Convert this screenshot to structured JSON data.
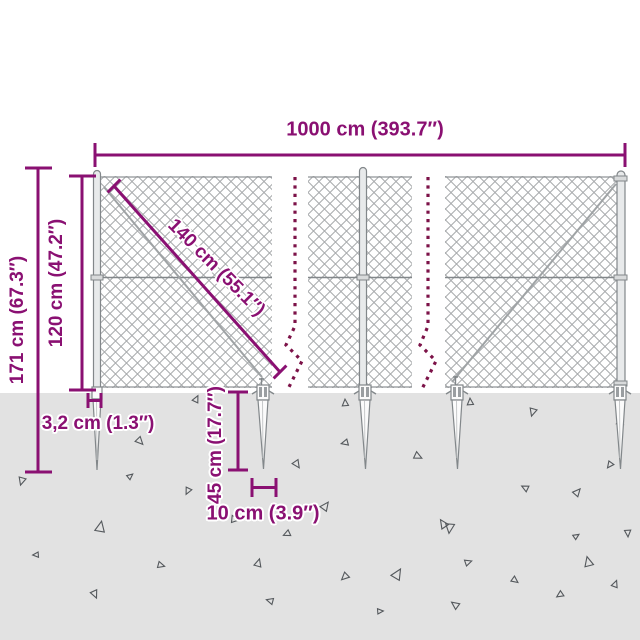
{
  "colors": {
    "dimension": "#8a1072",
    "break_line": "#7c1248",
    "ground": "#e2e2e2",
    "structure": "#82878a",
    "mesh": "#a8abad",
    "triangle": "#54585c",
    "background": "#ffffff"
  },
  "dimensions": {
    "total_width": "1000 cm (393.7″)",
    "total_height": "171 cm (67.3″)",
    "fence_height": "120 cm (47.2″)",
    "mesh_diagonal": "140 cm (55.1″)",
    "post_width": "3,2 cm (1.3″)",
    "spike_depth": "45 cm (17.7″)",
    "spike_width": "10 cm (3.9″)"
  },
  "ground": {
    "triangles": [
      [
        22,
        481,
        8,
        200
      ],
      [
        130,
        476,
        6,
        55
      ],
      [
        140,
        441,
        8,
        140
      ],
      [
        196,
        399,
        7,
        30
      ],
      [
        297,
        464,
        8,
        150
      ],
      [
        188,
        491,
        7,
        210
      ],
      [
        235,
        519,
        8,
        100
      ],
      [
        325,
        506,
        9,
        40
      ],
      [
        345,
        403,
        7,
        0
      ],
      [
        470,
        402,
        7,
        0
      ],
      [
        533,
        412,
        8,
        200
      ],
      [
        620,
        421,
        8,
        10
      ],
      [
        345,
        443,
        7,
        260
      ],
      [
        418,
        456,
        8,
        120
      ],
      [
        450,
        528,
        10,
        190
      ],
      [
        577,
        492,
        8,
        45
      ],
      [
        525,
        488,
        7,
        300
      ],
      [
        610,
        465,
        7,
        220
      ],
      [
        100,
        527,
        11,
        15
      ],
      [
        287,
        534,
        7,
        250
      ],
      [
        443,
        524,
        9,
        330
      ],
      [
        576,
        536,
        6,
        60
      ],
      [
        161,
        565,
        7,
        110
      ],
      [
        258,
        563,
        8,
        20
      ],
      [
        95,
        594,
        8,
        160
      ],
      [
        270,
        601,
        7,
        290
      ],
      [
        345,
        577,
        8,
        230
      ],
      [
        397,
        574,
        11,
        35
      ],
      [
        468,
        562,
        7,
        75
      ],
      [
        455,
        605,
        8,
        310
      ],
      [
        515,
        580,
        7,
        130
      ],
      [
        560,
        595,
        7,
        240
      ],
      [
        588,
        562,
        10,
        350
      ],
      [
        628,
        533,
        7,
        180
      ],
      [
        380,
        611,
        6,
        90
      ],
      [
        36,
        555,
        6,
        270
      ],
      [
        615,
        584,
        7,
        25
      ]
    ]
  }
}
